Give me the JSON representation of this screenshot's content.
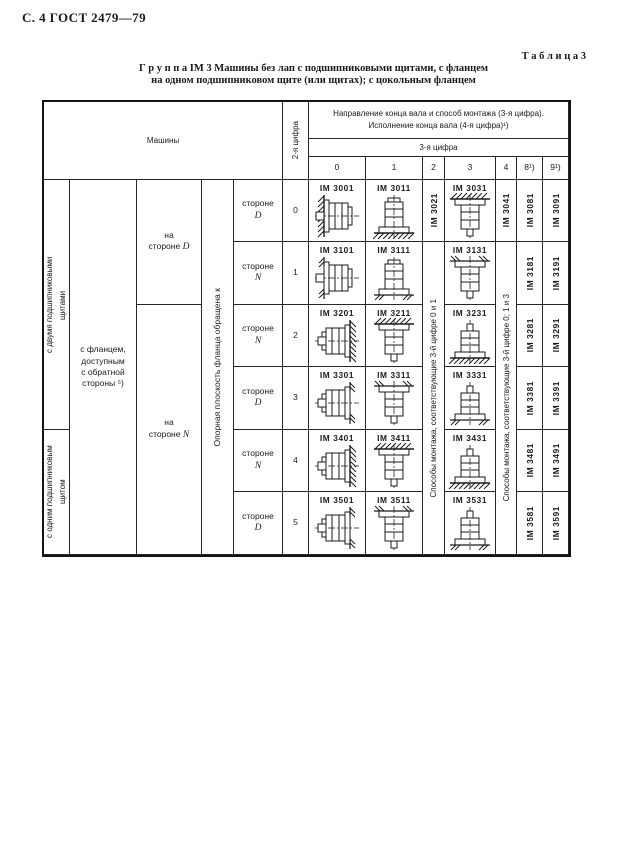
{
  "page": {
    "header_left": "С. 4 ГОСТ 2479—79",
    "table_label": "Т а б л и ц а  3",
    "title_line1": "Г р у п п а  IM 3   Машины без лап с подшипниковыми щитами, с фланцем",
    "title_line2": "на одном подшипниковом щите (или щитах); с цокольным фланцем"
  },
  "table": {
    "machines_header": "Машины",
    "second_digit_header": "2-я цифра",
    "direction_line1": "Направление конца вала и способ монтажа (3-я цифра).",
    "direction_line2": "Исполнение конца вала (4-я цифра)¹)",
    "third_digit_header": "3-я цифра",
    "digit_columns": [
      "0",
      "1",
      "2",
      "3",
      "4",
      "8¹)",
      "9¹)"
    ],
    "left": {
      "two_shields": "с двумя подшипниковыми щитами",
      "one_shield": "с одним подшипниковым щитом",
      "flange_note": [
        "с фланцем,",
        "доступным",
        "с обратной",
        "стороны ⁵)"
      ],
      "on_side_prefix": "на",
      "side_d_word": "стороне",
      "side_d_letter": "D",
      "side_n_word": "стороне",
      "side_n_letter": "N",
      "support_plane": "Опорная плоскость фланца обращена к"
    },
    "span2_text": "Способы монтажа, соответствующие 3-й цифре 0 и 1",
    "span4_text": "Способы монтажа, соответствующие 3-й цифре 0; 1 и 3",
    "rows": [
      {
        "digit": "0",
        "side_word": "стороне",
        "side_letter": "D",
        "c0": {
          "code": "IM 3001",
          "draw": "wall-left-hatch"
        },
        "c1": {
          "code": "IM 3011",
          "draw": "floor-hatch"
        },
        "c2": "IM 3021",
        "c3": {
          "code": "IM 3031",
          "draw": "ceil-hatch"
        },
        "c4": "IM 3041",
        "c8": "IM 3081",
        "c9": "IM 3091"
      },
      {
        "digit": "1",
        "side_word": "стороне",
        "side_letter": "N",
        "c0": {
          "code": "IM 3101",
          "draw": "wall-left-ticks"
        },
        "c1": {
          "code": "IM 3111",
          "draw": "floor-ticks"
        },
        "c3": {
          "code": "IM 3131",
          "draw": "ceil-ticks"
        },
        "c8": "IM 3181",
        "c9": "IM 3191"
      },
      {
        "digit": "2",
        "side_word": "стороне",
        "side_letter": "N",
        "c0": {
          "code": "IM 3201",
          "draw": "wall-right-hatch"
        },
        "c1": {
          "code": "IM 3211",
          "draw": "ceil-hatch"
        },
        "c3": {
          "code": "IM 3231",
          "draw": "floorup-hatch"
        },
        "c8": "IM 3281",
        "c9": "IM 3291"
      },
      {
        "digit": "3",
        "side_word": "стороне",
        "side_letter": "D",
        "c0": {
          "code": "IM 3301",
          "draw": "wall-right-ticks"
        },
        "c1": {
          "code": "IM 3311",
          "draw": "ceil-ticks"
        },
        "c3": {
          "code": "IM 3331",
          "draw": "floorup-ticks"
        },
        "c8": "IM 3381",
        "c9": "IM 3391"
      },
      {
        "digit": "4",
        "side_word": "стороне",
        "side_letter": "N",
        "c0": {
          "code": "IM 3401",
          "draw": "wall-right-hatch"
        },
        "c1": {
          "code": "IM 3411",
          "draw": "ceil-hatch"
        },
        "c3": {
          "code": "IM 3431",
          "draw": "floorup-hatch"
        },
        "c8": "IM 3481",
        "c9": "IM 3491"
      },
      {
        "digit": "5",
        "side_word": "стороне",
        "side_letter": "D",
        "c0": {
          "code": "IM 3501",
          "draw": "wall-right-ticks"
        },
        "c1": {
          "code": "IM 3511",
          "draw": "ceil-ticks"
        },
        "c3": {
          "code": "IM 3531",
          "draw": "floorup-ticks"
        },
        "c8": "IM 3581",
        "c9": "IM 3591"
      }
    ]
  }
}
